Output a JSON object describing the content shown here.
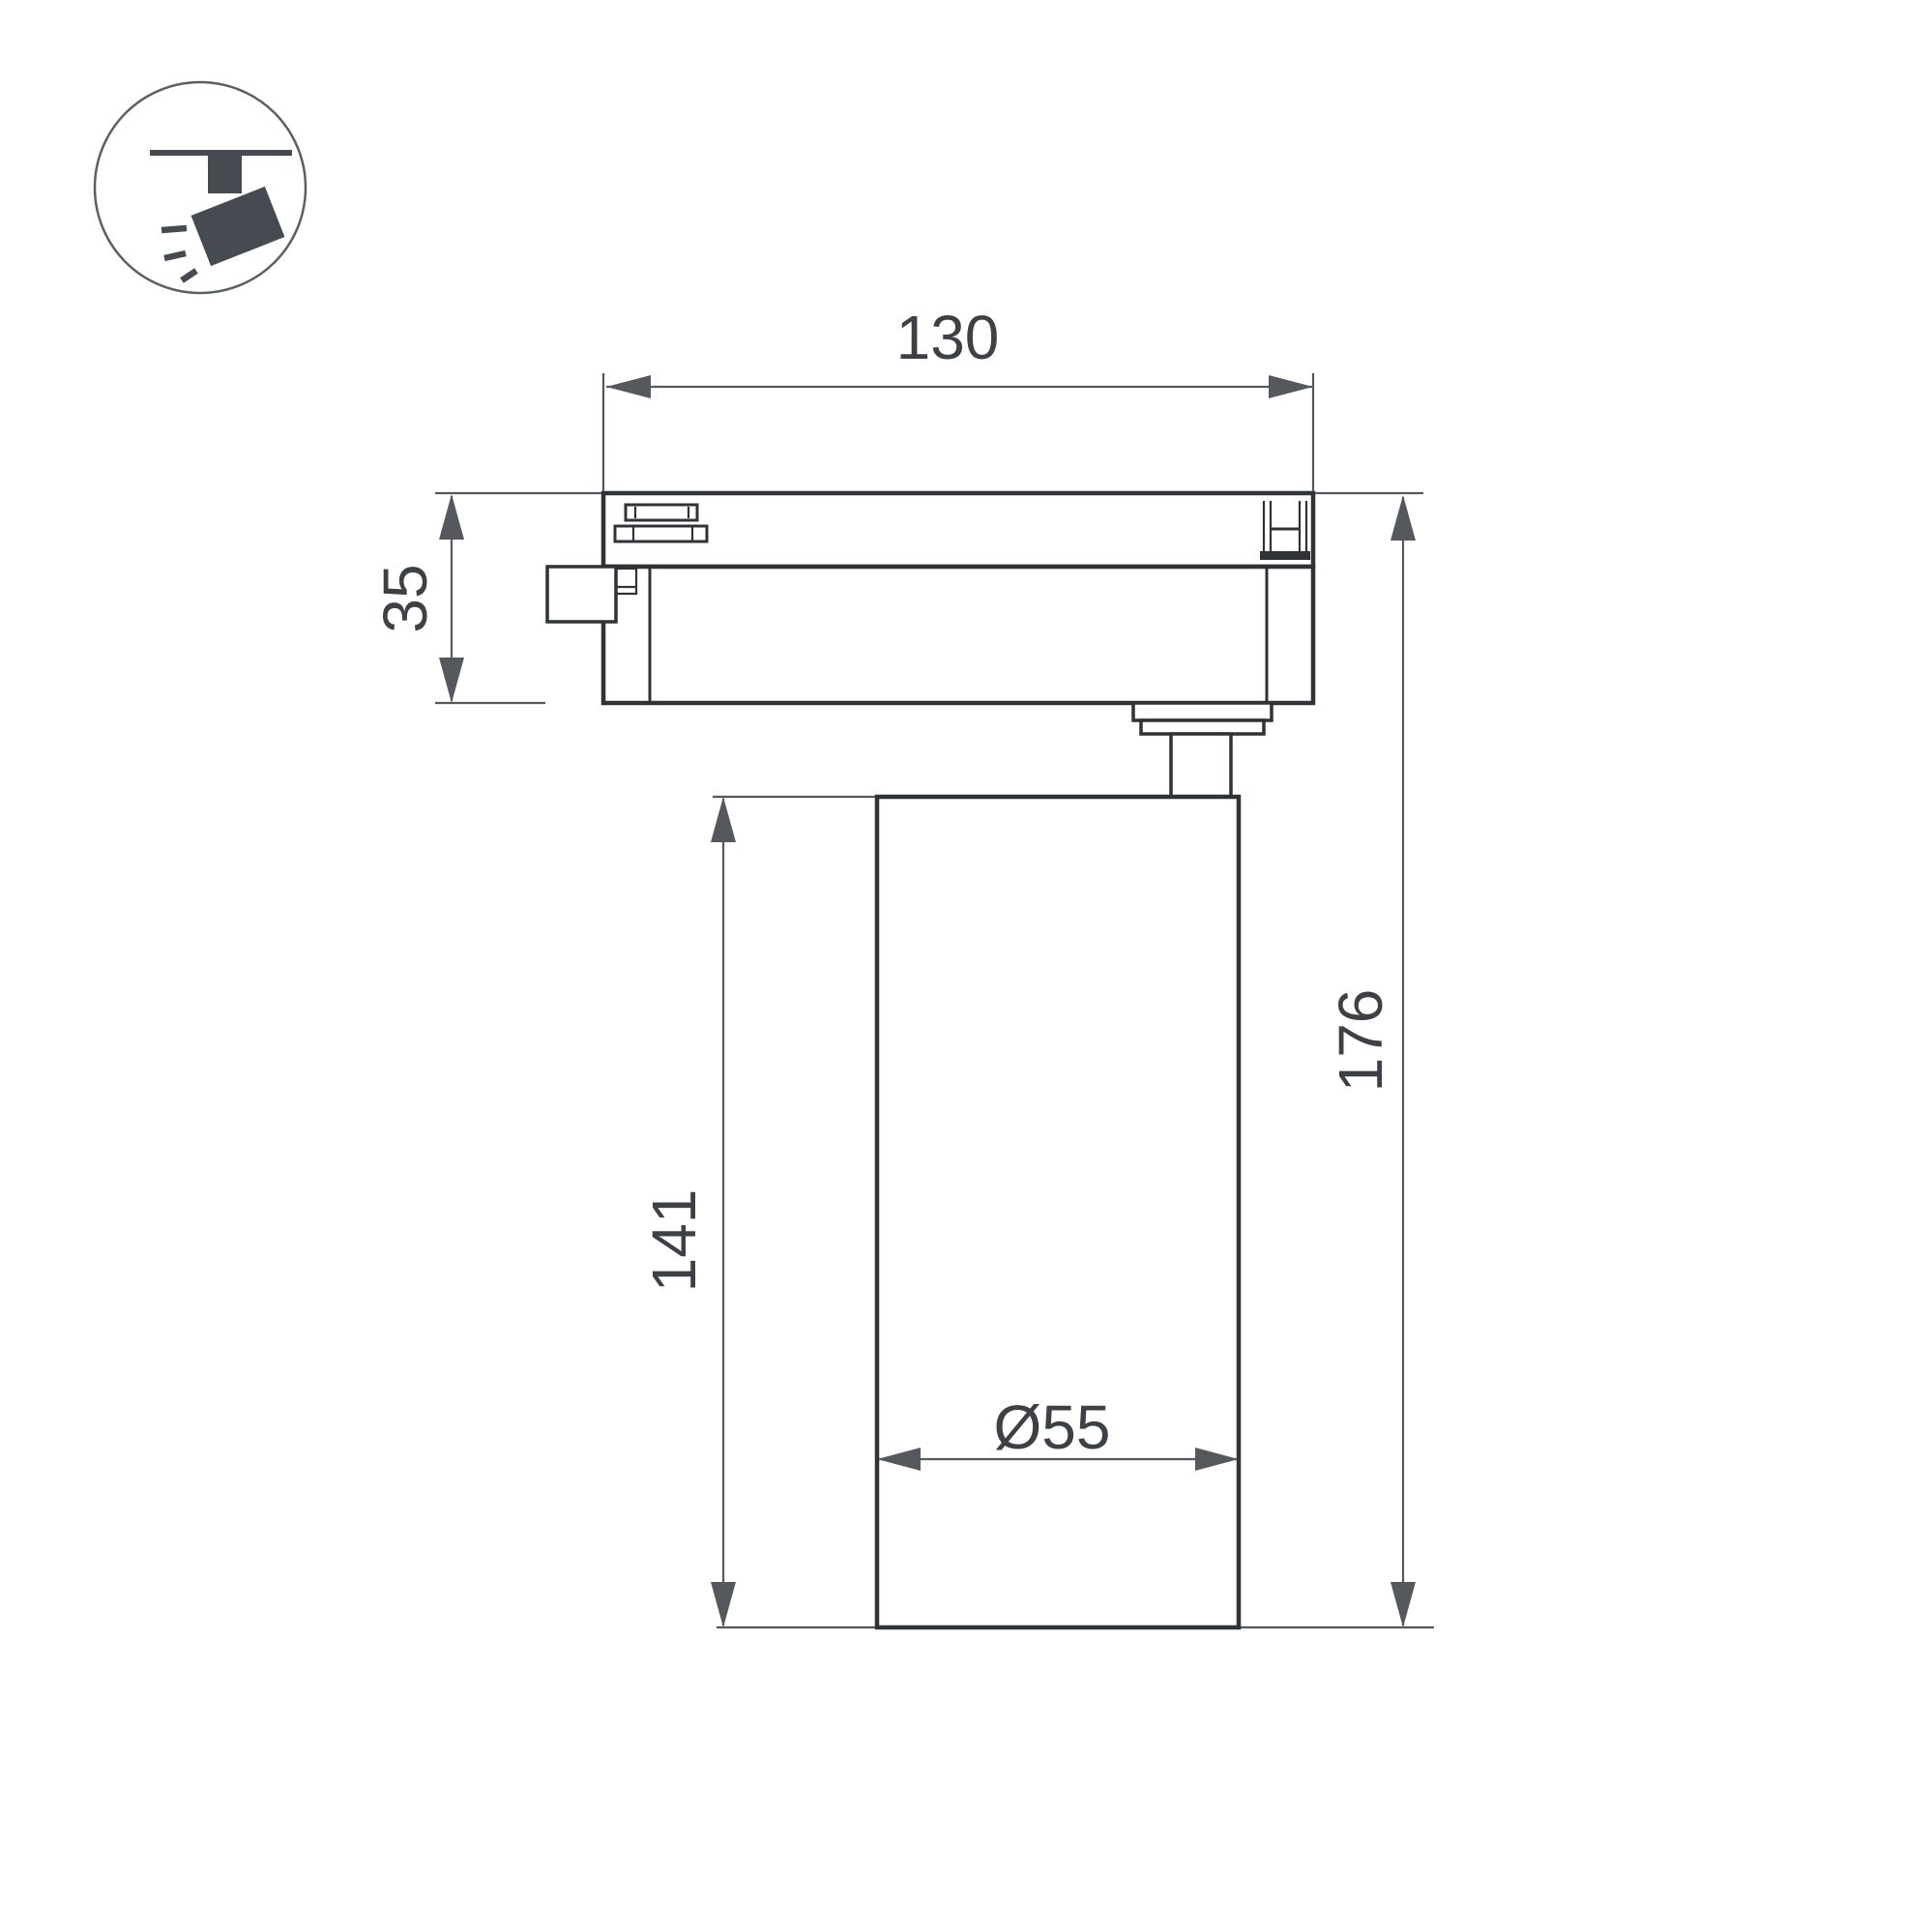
{
  "drawing": {
    "type": "technical-dimension-drawing",
    "subject": "track-mounted spotlight, side view",
    "labels": {
      "track_width": "130",
      "adapter_height": "35",
      "body_height": "141",
      "total_height": "176",
      "body_diameter": "Ø55"
    },
    "colors": {
      "outline": "#2f3337",
      "dimension_lines": "#55595e",
      "text": "#3d4146",
      "icon": "#454b51",
      "background": "#ffffff"
    }
  }
}
